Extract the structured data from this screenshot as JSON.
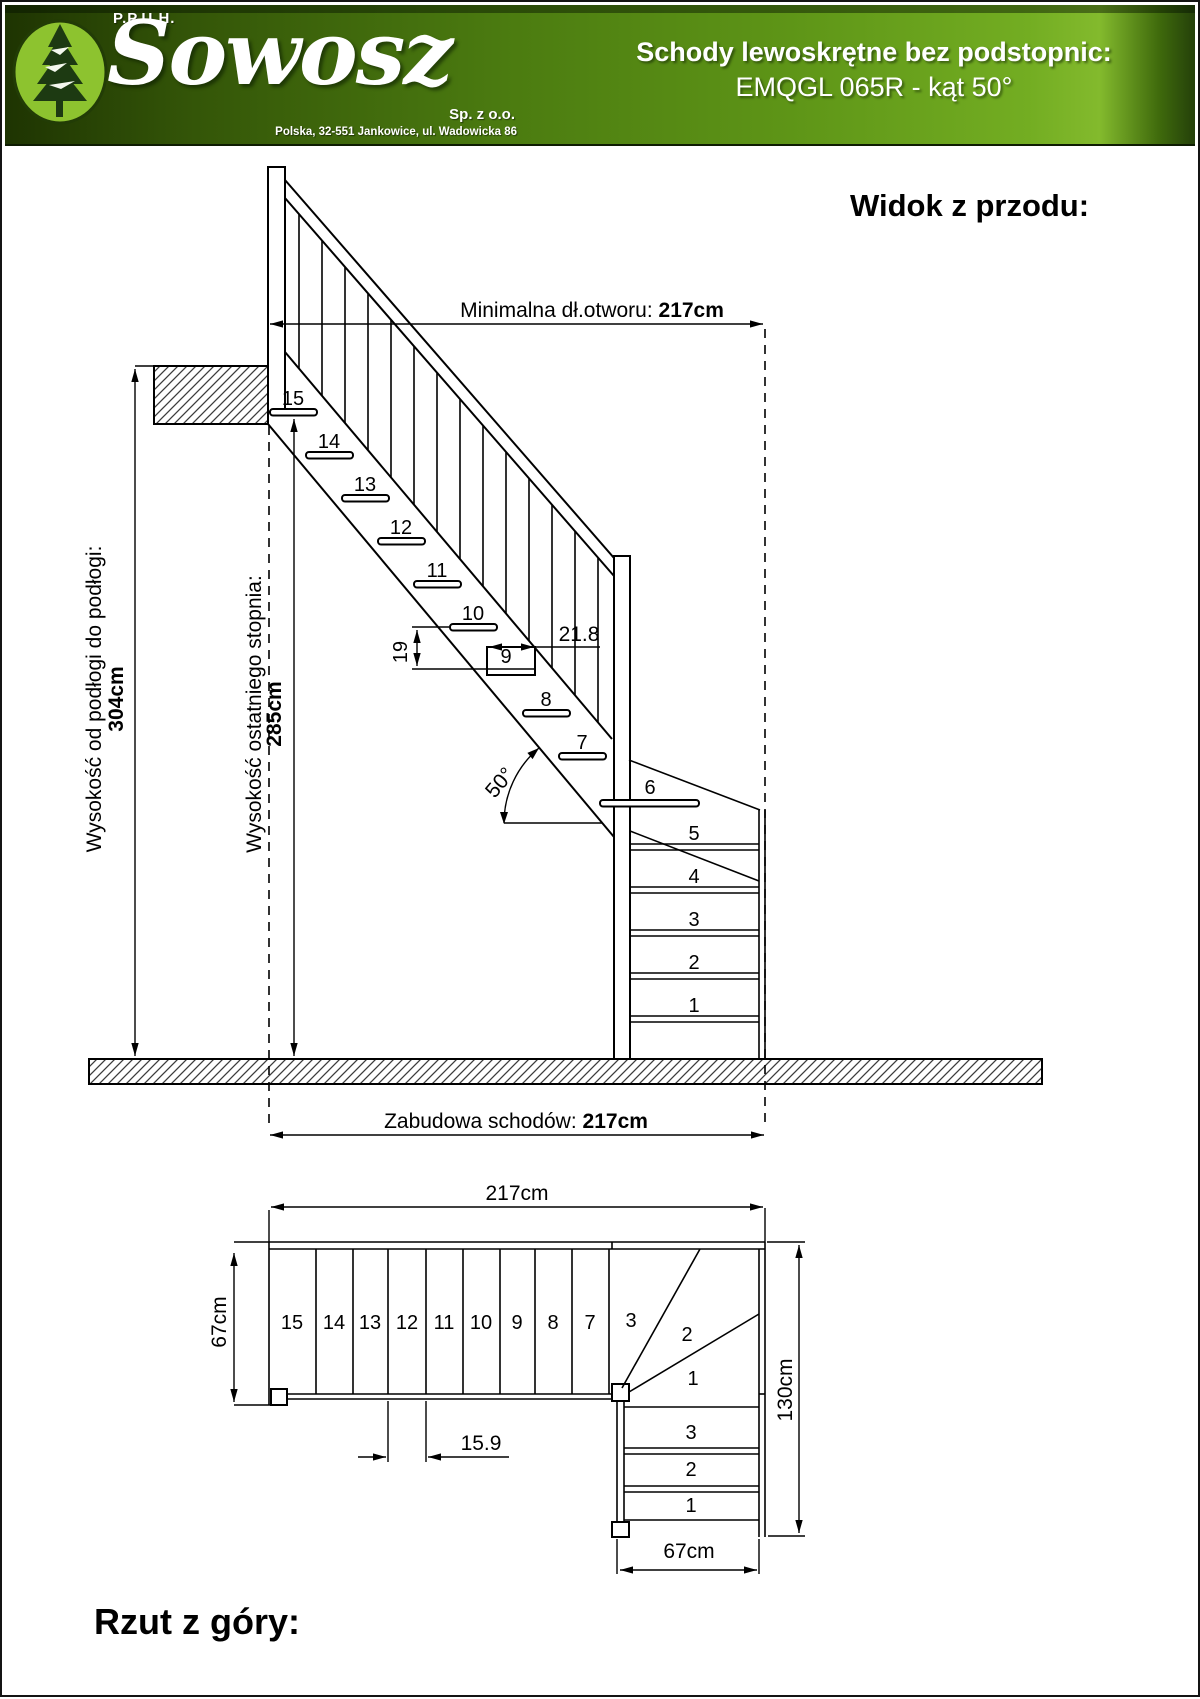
{
  "header": {
    "company_prefix": "P.P.U.H.",
    "brand": "Sowosz",
    "company_suffix": "Sp. z o.o.",
    "address": "Polska, 32-551 Jankowice, ul. Wadowicka 86",
    "product_title": "Schody lewoskrętne bez podstopnic:",
    "product_model": "EMQGL 065R - kąt 50°",
    "accent_color": "#5e9517"
  },
  "front_view": {
    "heading": "Widok z przodu:",
    "dims": {
      "opening_label": "Minimalna dł.otworu: ",
      "opening_value": "217cm",
      "floor_to_floor_label": "Wysokość od podłogi do podłogi:",
      "floor_to_floor_value": "304cm",
      "last_step_label": "Wysokość ostatniego stopnia:",
      "last_step_value": "285cm",
      "enclosure_label": "Zabudowa schodów: ",
      "enclosure_value": "217cm",
      "angle": "50°",
      "rise": "19",
      "tread_depth": "21.8"
    },
    "flight_steps": [
      "15",
      "14",
      "13",
      "12",
      "11",
      "10",
      "9",
      "8",
      "7"
    ],
    "winder_steps": [
      "6",
      "5",
      "4",
      "3",
      "2",
      "1"
    ]
  },
  "top_view": {
    "heading": "Rzut z góry:",
    "dims": {
      "width": "217cm",
      "flight_depth": "67cm",
      "right_depth": "130cm",
      "bottom_width": "67cm",
      "going": "15.9"
    },
    "straight_steps": [
      "15",
      "14",
      "13",
      "12",
      "11",
      "10",
      "9",
      "8",
      "7"
    ],
    "winder_steps": [
      "3",
      "2",
      "1"
    ],
    "lower_steps": [
      "3",
      "2",
      "1"
    ]
  }
}
